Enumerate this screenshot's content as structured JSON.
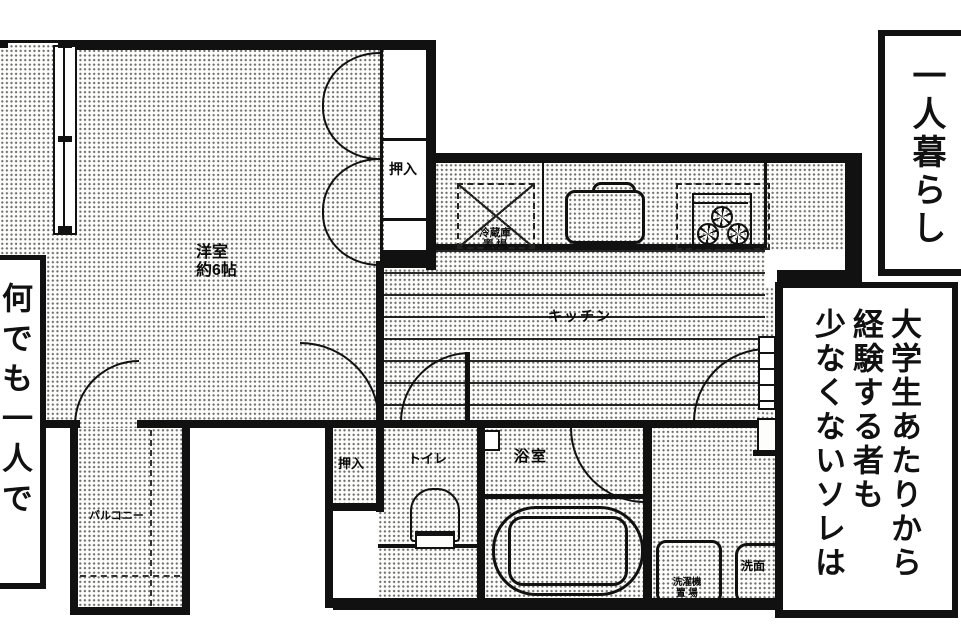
{
  "panel": {
    "speech_top_right": "一人暮らし",
    "speech_left": "何でも一人で",
    "speech_bottom_right": [
      "大学生あたりから",
      "経験する者も",
      "少なくないソレは"
    ]
  },
  "floorplan": {
    "room_label": "洋室",
    "room_size": "約6帖",
    "closet_top": "押入",
    "closet_bottom": "押入",
    "kitchen": "キッチン",
    "fridge_line1": "冷蔵庫",
    "fridge_line2": "置 場",
    "toilet": "トイレ",
    "bath": "浴室",
    "washer_line1": "洗濯機",
    "washer_line2": "置 場",
    "basin": "洗面",
    "balcony": "バルコニー"
  },
  "colors": {
    "ink": "#111111",
    "paper": "#ffffff"
  }
}
